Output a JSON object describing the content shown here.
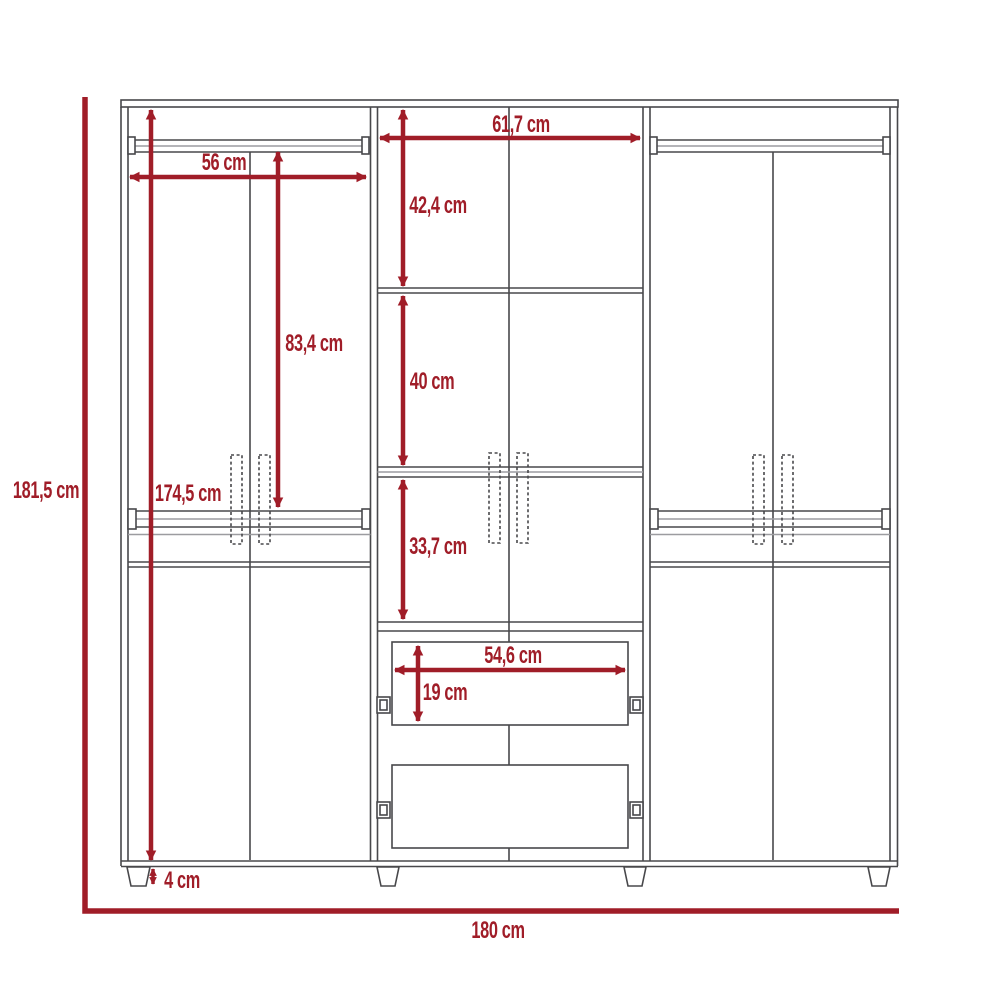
{
  "diagram": {
    "type": "furniture-dimension-diagram",
    "subject": "wardrobe front elevation with measurements",
    "unit": "cm",
    "colors": {
      "dimension_red": "#A01D28",
      "furniture_line_dark": "#48484B",
      "furniture_line_light": "#9C9CA0",
      "background": "#FFFFFF"
    },
    "dims": {
      "total_height": "181,5 cm",
      "interior_height": "174,5 cm",
      "left_rod_width": "56 cm",
      "rod_drop_height": "83,4 cm",
      "center_section_width": "61,7 cm",
      "top_shelf_height": "42,4 cm",
      "middle_shelf_height": "40 cm",
      "lower_shelf_height": "33,7 cm",
      "drawer_width": "54,6 cm",
      "drawer_height": "19 cm",
      "leg_height": "4 cm",
      "total_width": "180 cm"
    }
  }
}
